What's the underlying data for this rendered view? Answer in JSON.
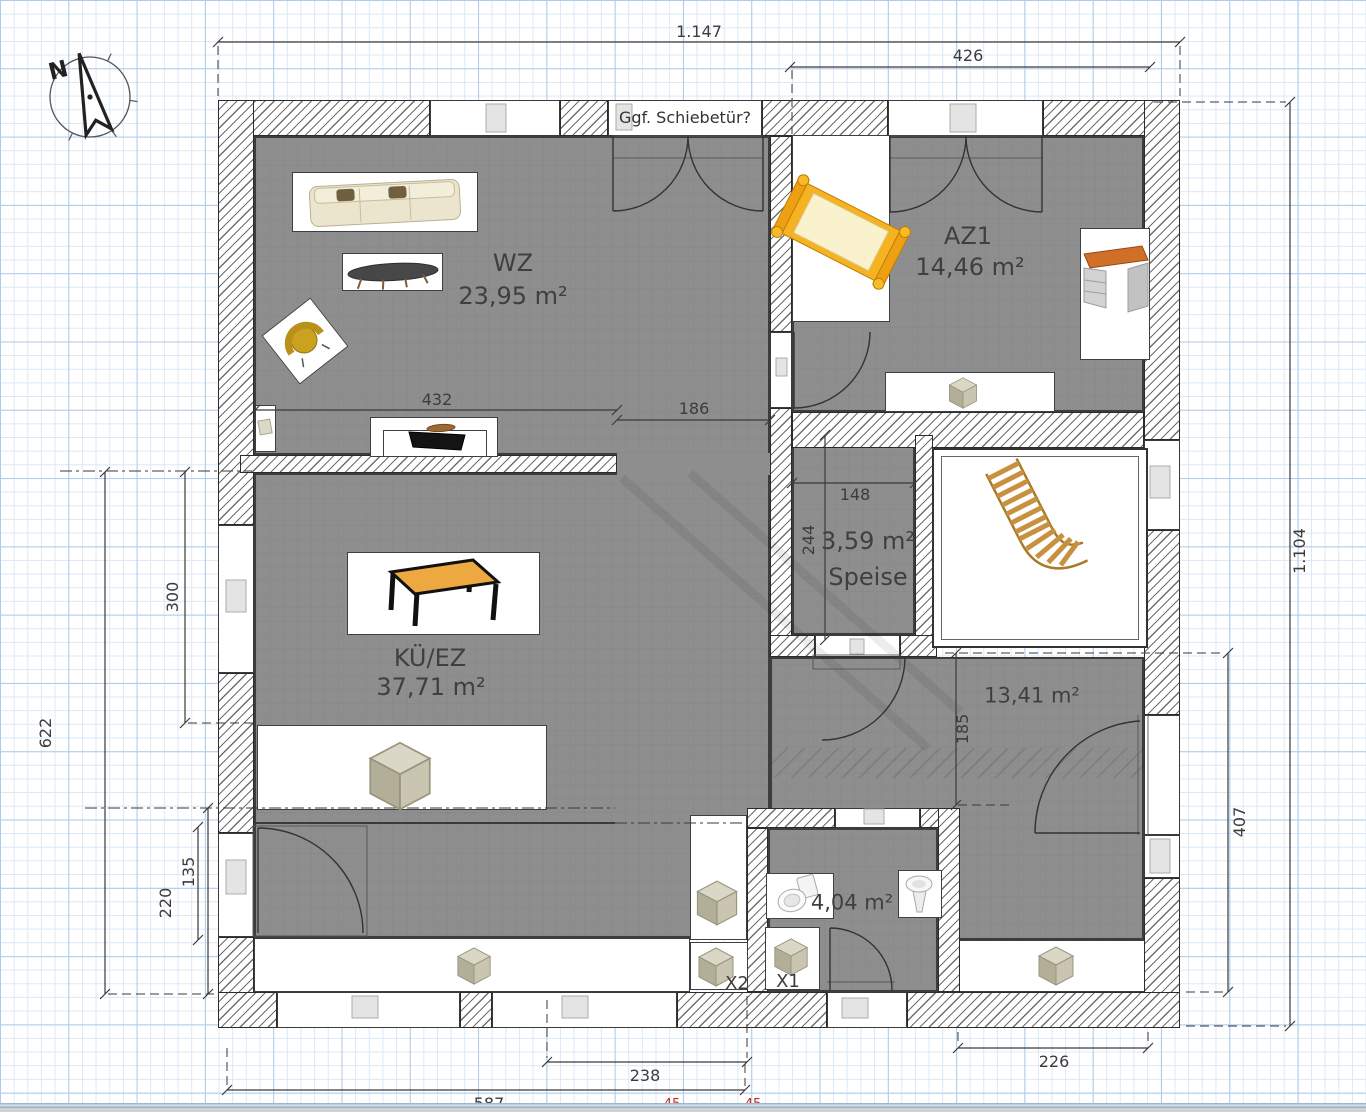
{
  "compass": {
    "label": "N"
  },
  "note": {
    "text": "Ggf. Schiebetür?"
  },
  "rooms": {
    "wz": {
      "name": "WZ",
      "area": "23,95 m²"
    },
    "az1": {
      "name": "AZ1",
      "area": "14,46 m²"
    },
    "kue_ez": {
      "name": "KÜ/EZ",
      "area": "37,71 m²"
    },
    "speise": {
      "name": "Speise",
      "area": "3,59 m²"
    },
    "zimmer2": {
      "area": "13,41 m²"
    },
    "bad": {
      "area": "4,04 m²"
    }
  },
  "markers": {
    "x1": "X1",
    "x2": "X2"
  },
  "dimensions": {
    "total_width": "1.147",
    "az1_width": "426",
    "total_height": "1.104",
    "left_height": "622",
    "kue_left_height": "300",
    "entry_left_height": "220",
    "left_window": "135",
    "wz_width": "432",
    "hall_width": "186",
    "speise_width": "148",
    "speise_depth": "244",
    "zimmer2_depth": "185",
    "right_depth": "407",
    "bath_bottom_width": "238",
    "bottom_left_width": "587",
    "bottom_right_width": "226"
  },
  "clipped_red_dims": [
    "45",
    "45"
  ],
  "colors": {
    "grid_minor": "#dbe8f6",
    "grid_major": "#aecbe9",
    "room_fill": "#8e8e8e",
    "wall_hatch": "#6e6e6e",
    "dim_text": "#3c3c3c",
    "red_dim": "#cc2222",
    "stairs_wood": "#c8913f",
    "bed_orange": "#f2a61e",
    "table_orange": "#eda93f",
    "desk_orange": "#cf7026",
    "armchair_yellow": "#caa21f",
    "box_khaki": "#c9c5b1"
  }
}
